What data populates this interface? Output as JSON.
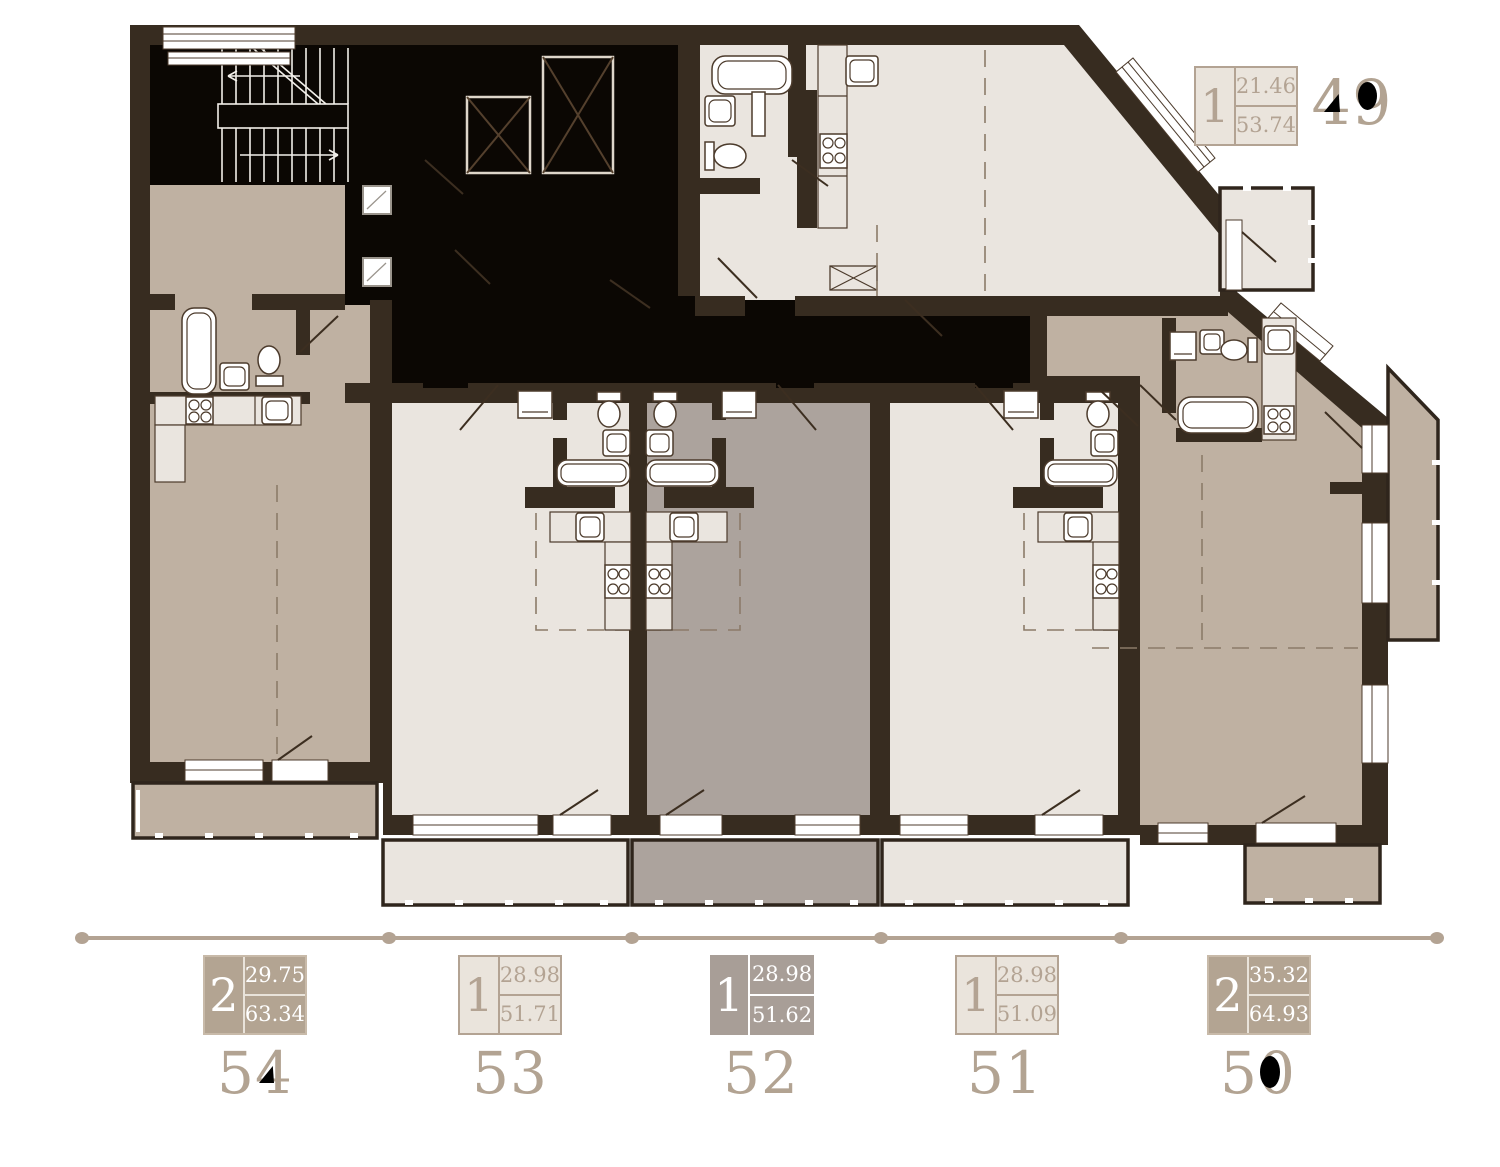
{
  "plan": {
    "name": "floor-plan",
    "selected_apartment": "52",
    "colors": {
      "wall": "#372c20",
      "core_black": "#0b0703",
      "room_light": "#eae5df",
      "room_tan": "#bfb1a2",
      "room_selected": "#aca39d",
      "accent_tan": "#b3a393",
      "badge_dark_bg": "#b3a492",
      "badge_selected_bg": "#a89e97",
      "badge_text_light": "#b3a393",
      "badge_text_dark": "#ffffff"
    }
  },
  "apartments": [
    {
      "number": "49",
      "rooms": "1",
      "living_area": "21.46",
      "total_area": "53.74",
      "variant": "light"
    },
    {
      "number": "54",
      "rooms": "2",
      "living_area": "29.75",
      "total_area": "63.34",
      "variant": "dark"
    },
    {
      "number": "53",
      "rooms": "1",
      "living_area": "28.98",
      "total_area": "51.71",
      "variant": "light"
    },
    {
      "number": "52",
      "rooms": "1",
      "living_area": "28.98",
      "total_area": "51.62",
      "variant": "selected"
    },
    {
      "number": "51",
      "rooms": "1",
      "living_area": "28.98",
      "total_area": "51.09",
      "variant": "light"
    },
    {
      "number": "50",
      "rooms": "2",
      "living_area": "35.32",
      "total_area": "64.93",
      "variant": "dark"
    }
  ]
}
